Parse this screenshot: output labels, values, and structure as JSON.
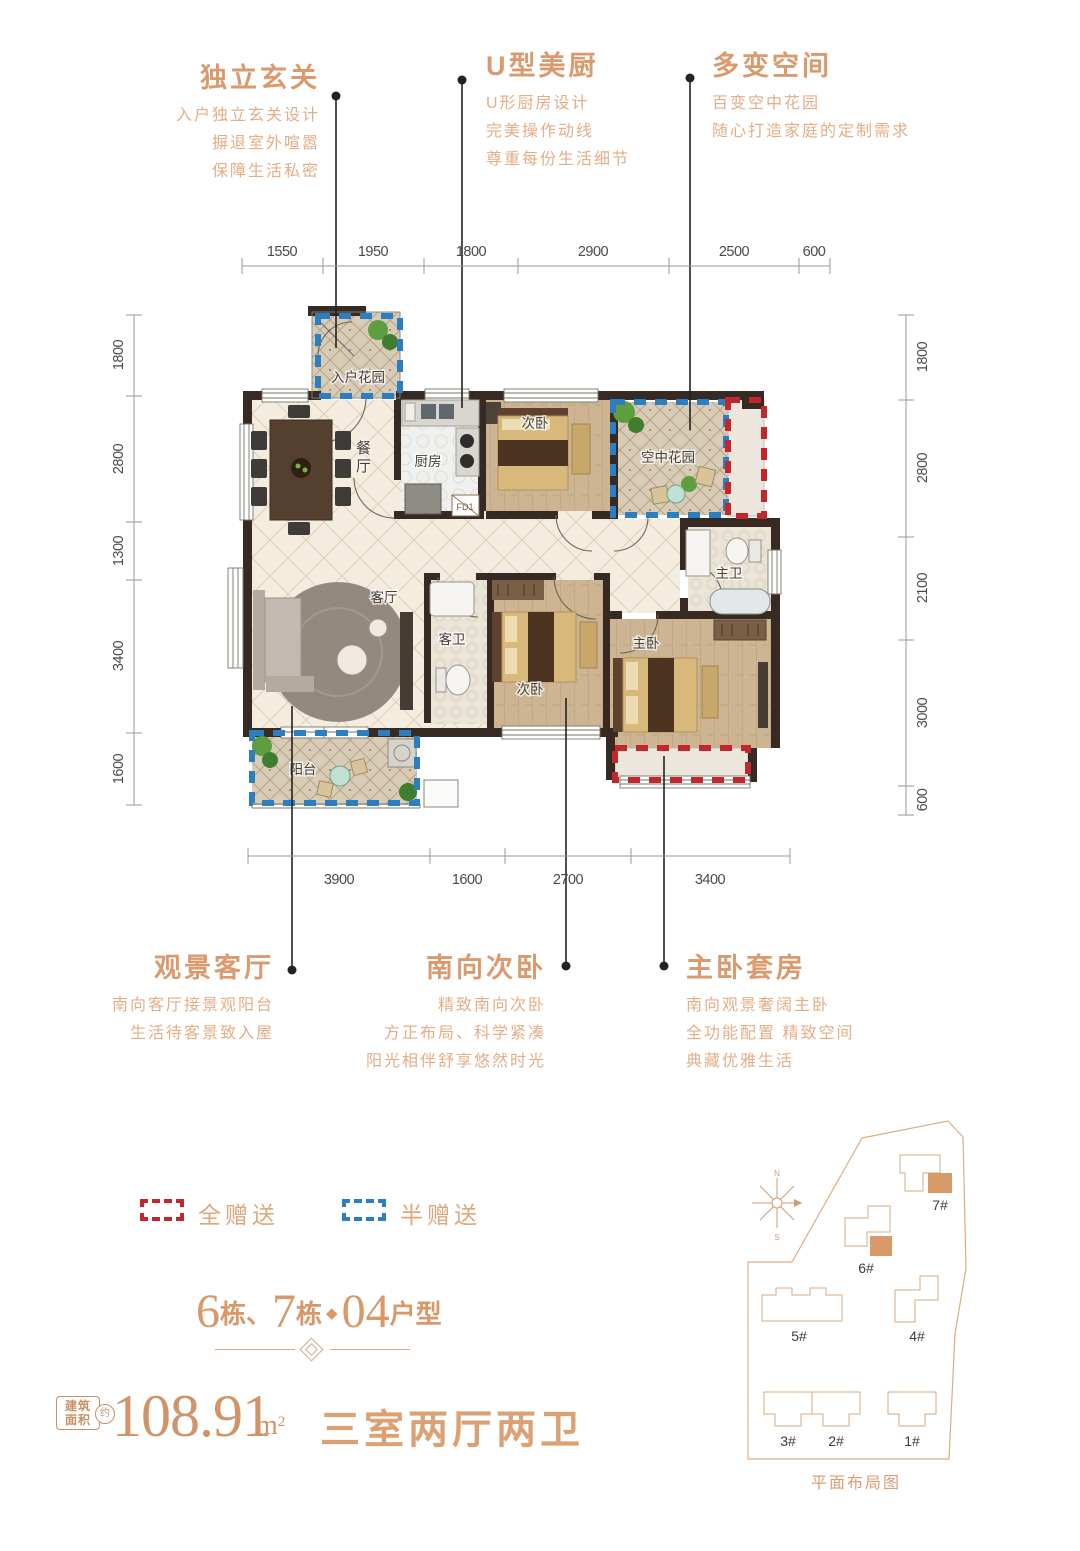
{
  "colors": {
    "accent": "#db9a6e",
    "accent_light": "#e4ae87",
    "legend_full_red": "#c1272d",
    "legend_half_blue": "#2b7ec2",
    "wall": "#362a22"
  },
  "features_top": [
    {
      "title": "独立玄关",
      "lines": [
        "入户独立玄关设计",
        "摒退室外喧嚣",
        "保障生活私密"
      ]
    },
    {
      "title": "U型美厨",
      "lines": [
        "U形厨房设计",
        "完美操作动线",
        "尊重每份生活细节"
      ]
    },
    {
      "title": "多变空间",
      "lines": [
        "百变空中花园",
        "随心打造家庭的定制需求"
      ]
    }
  ],
  "features_bottom": [
    {
      "title": "观景客厅",
      "lines": [
        "南向客厅接景观阳台",
        "生活待客景致入屋"
      ]
    },
    {
      "title": "南向次卧",
      "lines": [
        "精致南向次卧",
        "方正布局、科学紧凑",
        "阳光相伴舒享悠然时光"
      ]
    },
    {
      "title": "主卧套房",
      "lines": [
        "南向观景奢阔主卧",
        "全功能配置 精致空间",
        "典藏优雅生活"
      ]
    }
  ],
  "plan": {
    "rooms": {
      "entry_garden": "入户花园",
      "dining": "餐厅",
      "kitchen": "厨房",
      "bedroom_north": "次卧",
      "sky_garden": "空中花园",
      "master_bath": "主卫",
      "living": "客厅",
      "guest_bath": "客卫",
      "bedroom_south": "次卧",
      "master_bedroom": "主卧",
      "balcony": "阳台"
    },
    "fd": "FD1"
  },
  "dims": {
    "top": [
      "1550",
      "1950",
      "1800",
      "2900",
      "2500",
      "600"
    ],
    "bottom": [
      "3900",
      "1600",
      "2700",
      "3400"
    ],
    "left": [
      "1800",
      "2800",
      "1300",
      "3400",
      "1600"
    ],
    "right": [
      "1800",
      "2800",
      "2100",
      "3000",
      "600"
    ]
  },
  "legend": {
    "full": "全赠送",
    "half": "半赠送"
  },
  "unit_title": {
    "n1": "6",
    "u1": "栋",
    "sep": "、",
    "n2": "7",
    "u2": "栋",
    "diamond": "◆",
    "n3": "04",
    "u3": "户型"
  },
  "area": {
    "badge_line1": "建筑",
    "badge_line2": "面积",
    "approx": "约",
    "value": "108.91",
    "unit_base": "m",
    "unit_exp": "2",
    "layout": "三室两厅两卫"
  },
  "site": {
    "caption": "平面布局图",
    "buildings": {
      "b1": "1#",
      "b2": "2#",
      "b3": "3#",
      "b4": "4#",
      "b5": "5#",
      "b6": "6#",
      "b7": "7#"
    },
    "compass": {
      "north": "N",
      "south": "S"
    }
  }
}
